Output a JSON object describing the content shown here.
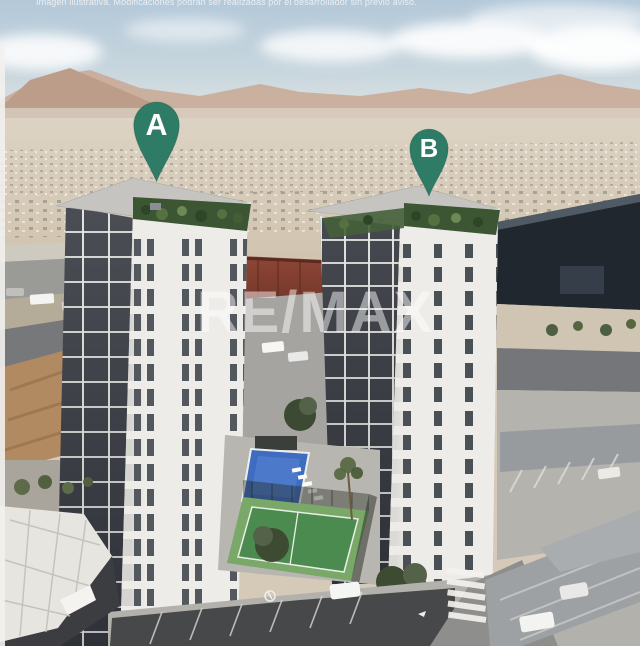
{
  "disclaimer": "Imagen ilustrativa. Modificaciones podrán ser realizadas por el desarrollador sin previo aviso.",
  "watermark": "RE/MAX",
  "pins": {
    "a": {
      "label": "A"
    },
    "b": {
      "label": "B"
    }
  },
  "colors": {
    "pin": "#2e7c66",
    "pool": "#3e6cc0",
    "court": "#4c8b50",
    "court_apron": "#7aa869",
    "warehouse": "#20272f",
    "sky": "#b3c8d9",
    "mountains": "#c9ad9b",
    "desert": "#d5cab8",
    "tower_light": "#edece8",
    "tower_shadow": "#363a41",
    "canopy": "#e7e5e0"
  }
}
